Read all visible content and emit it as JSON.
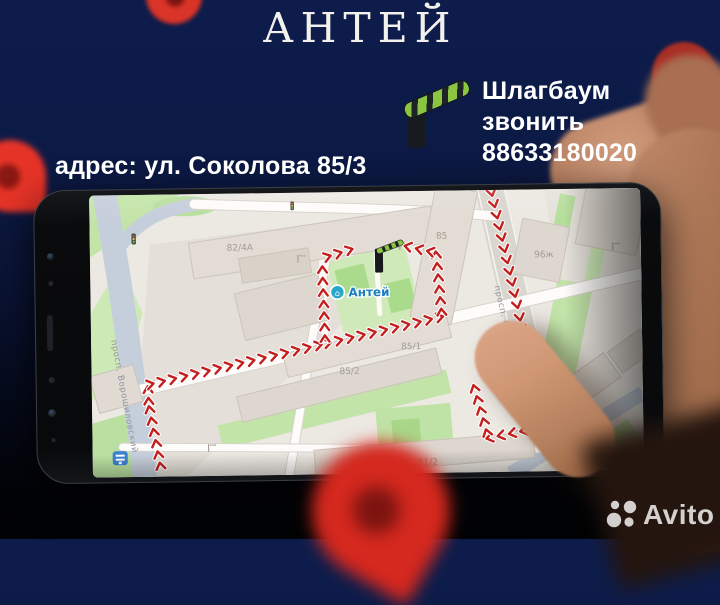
{
  "header": {
    "title": "АНТЕЙ"
  },
  "barrier_note": {
    "label": "Шлагбаум",
    "phone_line": "звонить 88633180020"
  },
  "address_line": "адрес: ул. Соколова 85/3",
  "map": {
    "poi_label": "Антей",
    "street_labels": {
      "voroshilovsky": "просп. Ворошиловский",
      "sokolova": "просп. Соколова"
    },
    "building_labels": {
      "b82": "82/4А",
      "b85": "85",
      "b96": "96ж",
      "b85_1": "85/1",
      "b85_2": "85/2",
      "b81_2": "81/2"
    },
    "route": {
      "color": "#c41f1f",
      "chevron_spacing": 11.5,
      "legs": [
        [
          [
            68,
            274
          ],
          [
            57,
            212
          ],
          [
            56,
            192
          ]
        ],
        [
          [
            56,
            190
          ],
          [
            231,
            152
          ],
          [
            351,
            126
          ]
        ],
        [
          [
            234,
            149
          ],
          [
            232,
            66
          ],
          [
            266,
            56
          ]
        ],
        [
          [
            351,
            124
          ],
          [
            346,
            62
          ],
          [
            308,
            53
          ]
        ],
        [
          [
            402,
            0
          ],
          [
            428,
            122
          ],
          [
            448,
            238
          ],
          [
            396,
            248
          ],
          [
            381,
            192
          ]
        ]
      ]
    }
  },
  "watermark": {
    "brand": "Avito"
  },
  "colors": {
    "background_navy": "#0c1a45",
    "pin_red": "#e63327",
    "pin_dark_red": "#a82e24",
    "map_background": "#ece8e2",
    "route_red": "#c41f1f",
    "barrier_arm_green": "#8bc541",
    "poi_blue": "#2086c8"
  }
}
